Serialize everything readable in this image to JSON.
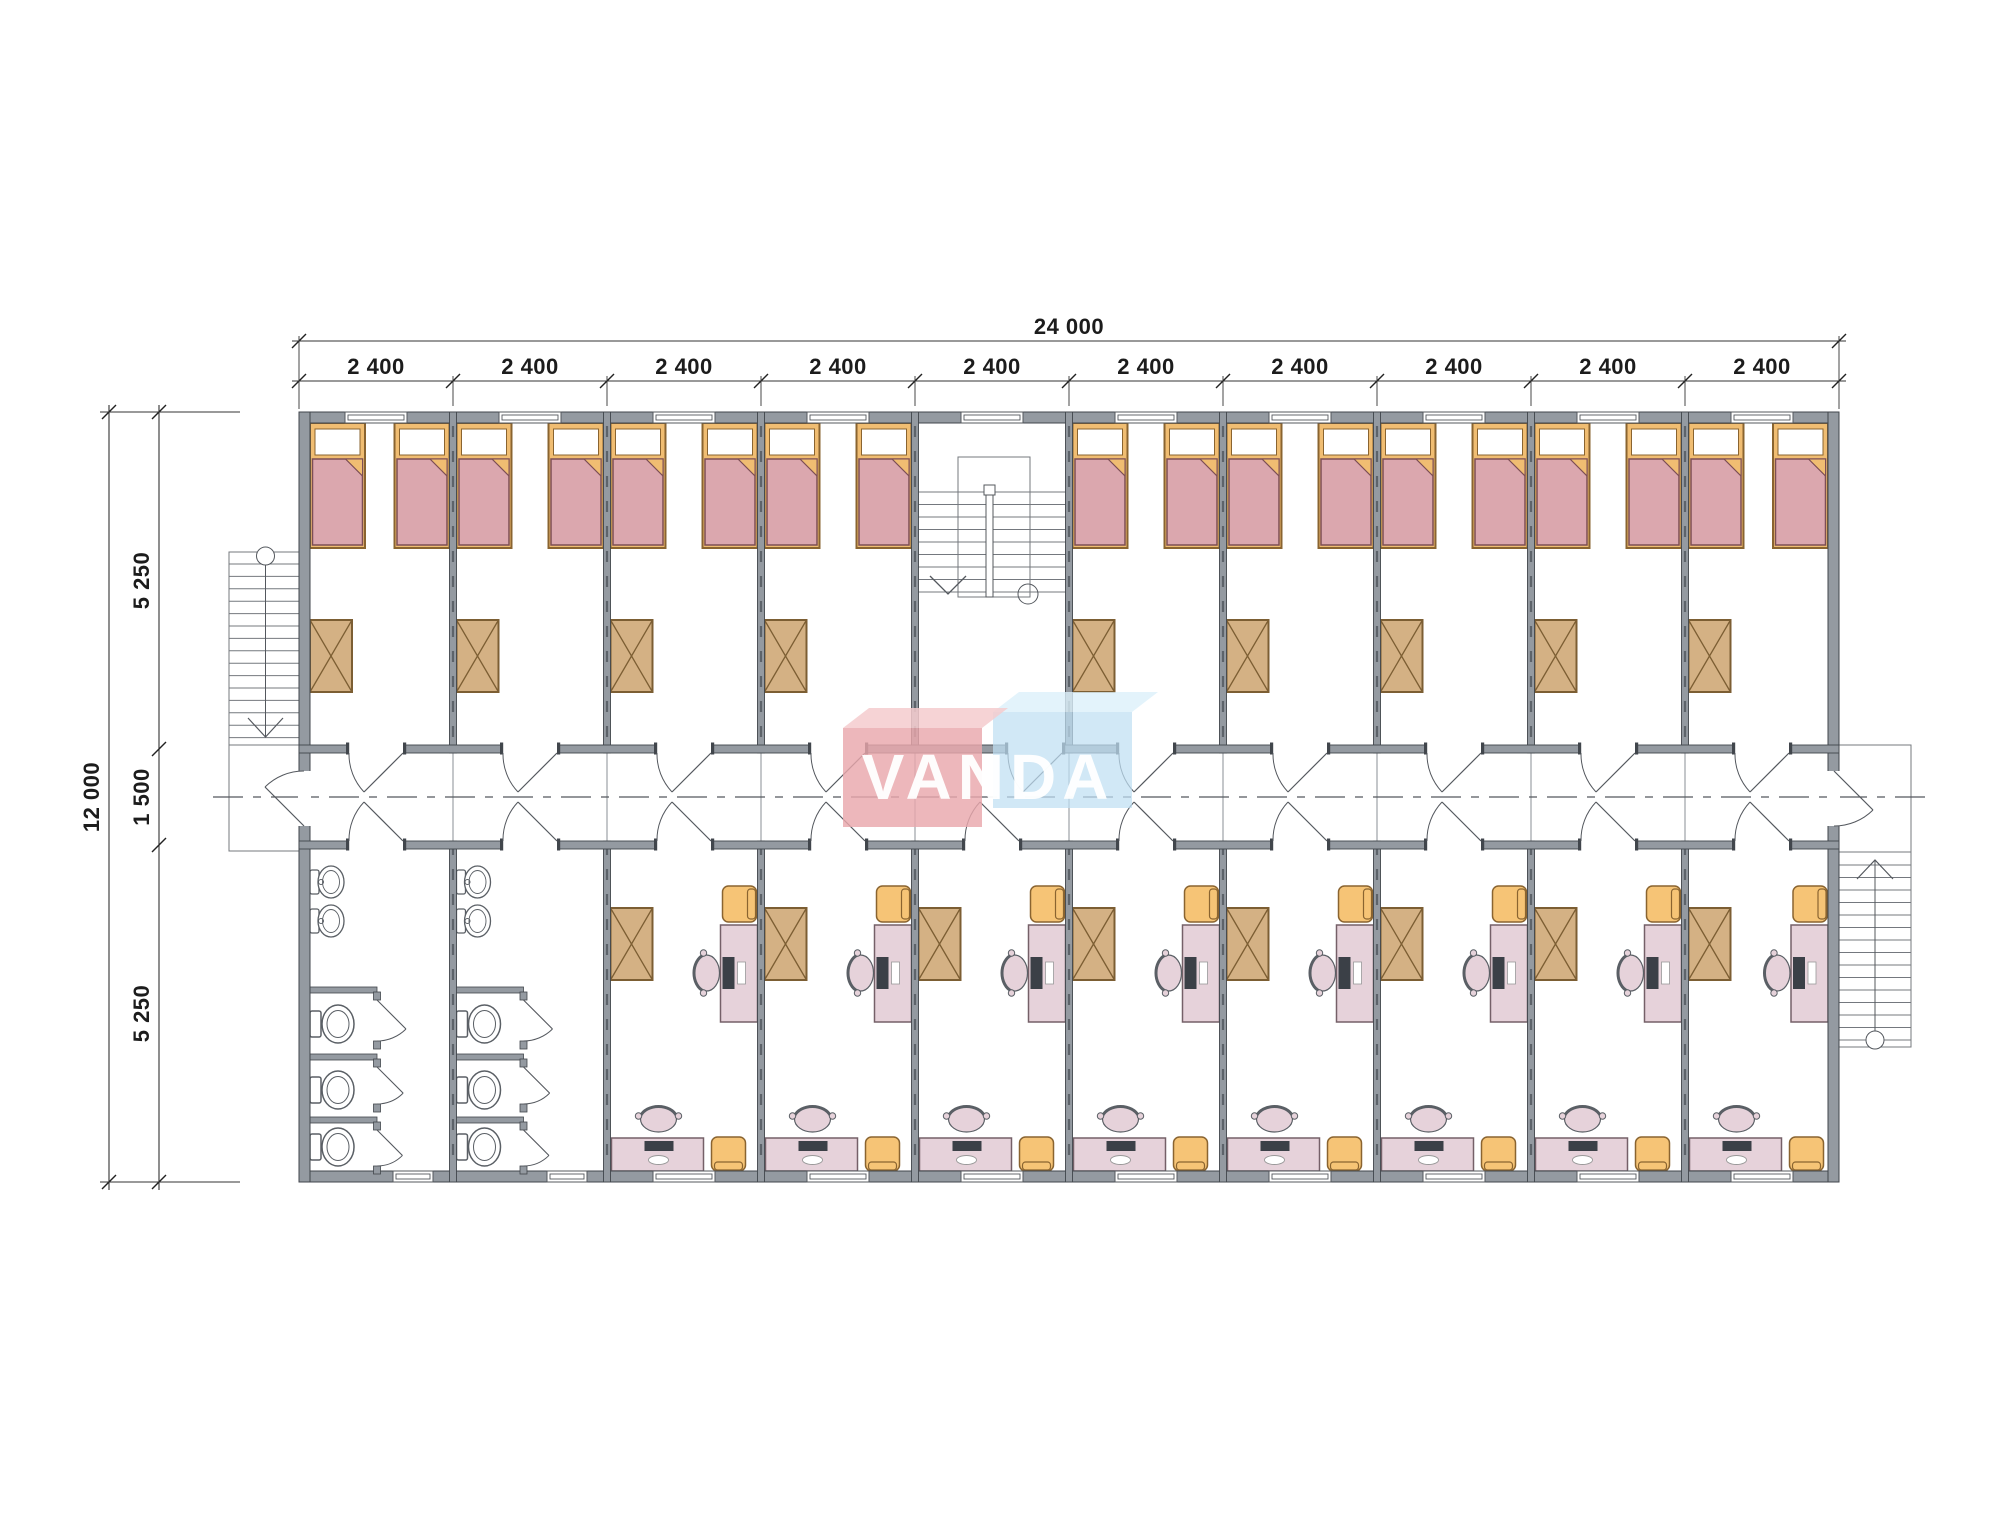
{
  "page": {
    "width": 2000,
    "height": 1520,
    "background": "#ffffff"
  },
  "drawing": {
    "type": "floor-plan",
    "overall_width_label": "24 000",
    "bay_labels": [
      "2 400",
      "2 400",
      "2 400",
      "2 400",
      "2 400",
      "2 400",
      "2 400",
      "2 400",
      "2 400",
      "2 400"
    ],
    "bay_count": 10,
    "overall_depth_label": "12 000",
    "depth_zone_labels": [
      "5 250",
      "1 500",
      "5 250"
    ],
    "modules": [
      {
        "id": 1,
        "top": "bedroom",
        "bottom": "bathroom"
      },
      {
        "id": 2,
        "top": "bedroom",
        "bottom": "bathroom"
      },
      {
        "id": 3,
        "top": "bedroom",
        "bottom": "office"
      },
      {
        "id": 4,
        "top": "bedroom",
        "bottom": "office"
      },
      {
        "id": 5,
        "top": "staircase",
        "bottom": "office"
      },
      {
        "id": 6,
        "top": "bedroom",
        "bottom": "office"
      },
      {
        "id": 7,
        "top": "bedroom",
        "bottom": "office"
      },
      {
        "id": 8,
        "top": "bedroom",
        "bottom": "office"
      },
      {
        "id": 9,
        "top": "bedroom",
        "bottom": "office"
      },
      {
        "id": 10,
        "top": "bedroom",
        "bottom": "office"
      }
    ],
    "bedroom_furniture": [
      "bed",
      "bed",
      "table"
    ],
    "office_furniture": [
      "table",
      "desk",
      "office-chair",
      "armchair",
      "desk",
      "office-chair",
      "armchair"
    ],
    "bathroom_fixtures": [
      "sink",
      "sink",
      "toilet",
      "toilet",
      "toilet"
    ],
    "exterior": [
      "stair-left",
      "stair-right",
      "landing-left",
      "landing-right"
    ]
  },
  "watermark": {
    "text": "VANDA"
  },
  "colors": {
    "wall": "#949aa1",
    "wall_dark": "#41464c",
    "wall_dash": "#5d636a",
    "line": "#54585e",
    "thin": "#74787e",
    "dim": "#1c1c1c",
    "bed_frame": "#f0bd72",
    "bed_frame_line": "#8a6430",
    "blanket": "#dba7ae",
    "blanket_line": "#7d4f55",
    "pillow": "#ffffff",
    "table": "#d4b184",
    "table_line": "#7c5e33",
    "desk": "#e6d2da",
    "desk_line": "#756068",
    "monitor": "#3b4047",
    "armchair": "#f6c476",
    "armchair_line": "#8a6430",
    "fixture_line": "#5a5f65",
    "logo_pink": "#e9a7ac",
    "logo_pink_top": "#f4cbce",
    "logo_blue": "#bfdff2",
    "logo_blue_top": "#dcf0fa",
    "logo_text": "#ffffff"
  }
}
